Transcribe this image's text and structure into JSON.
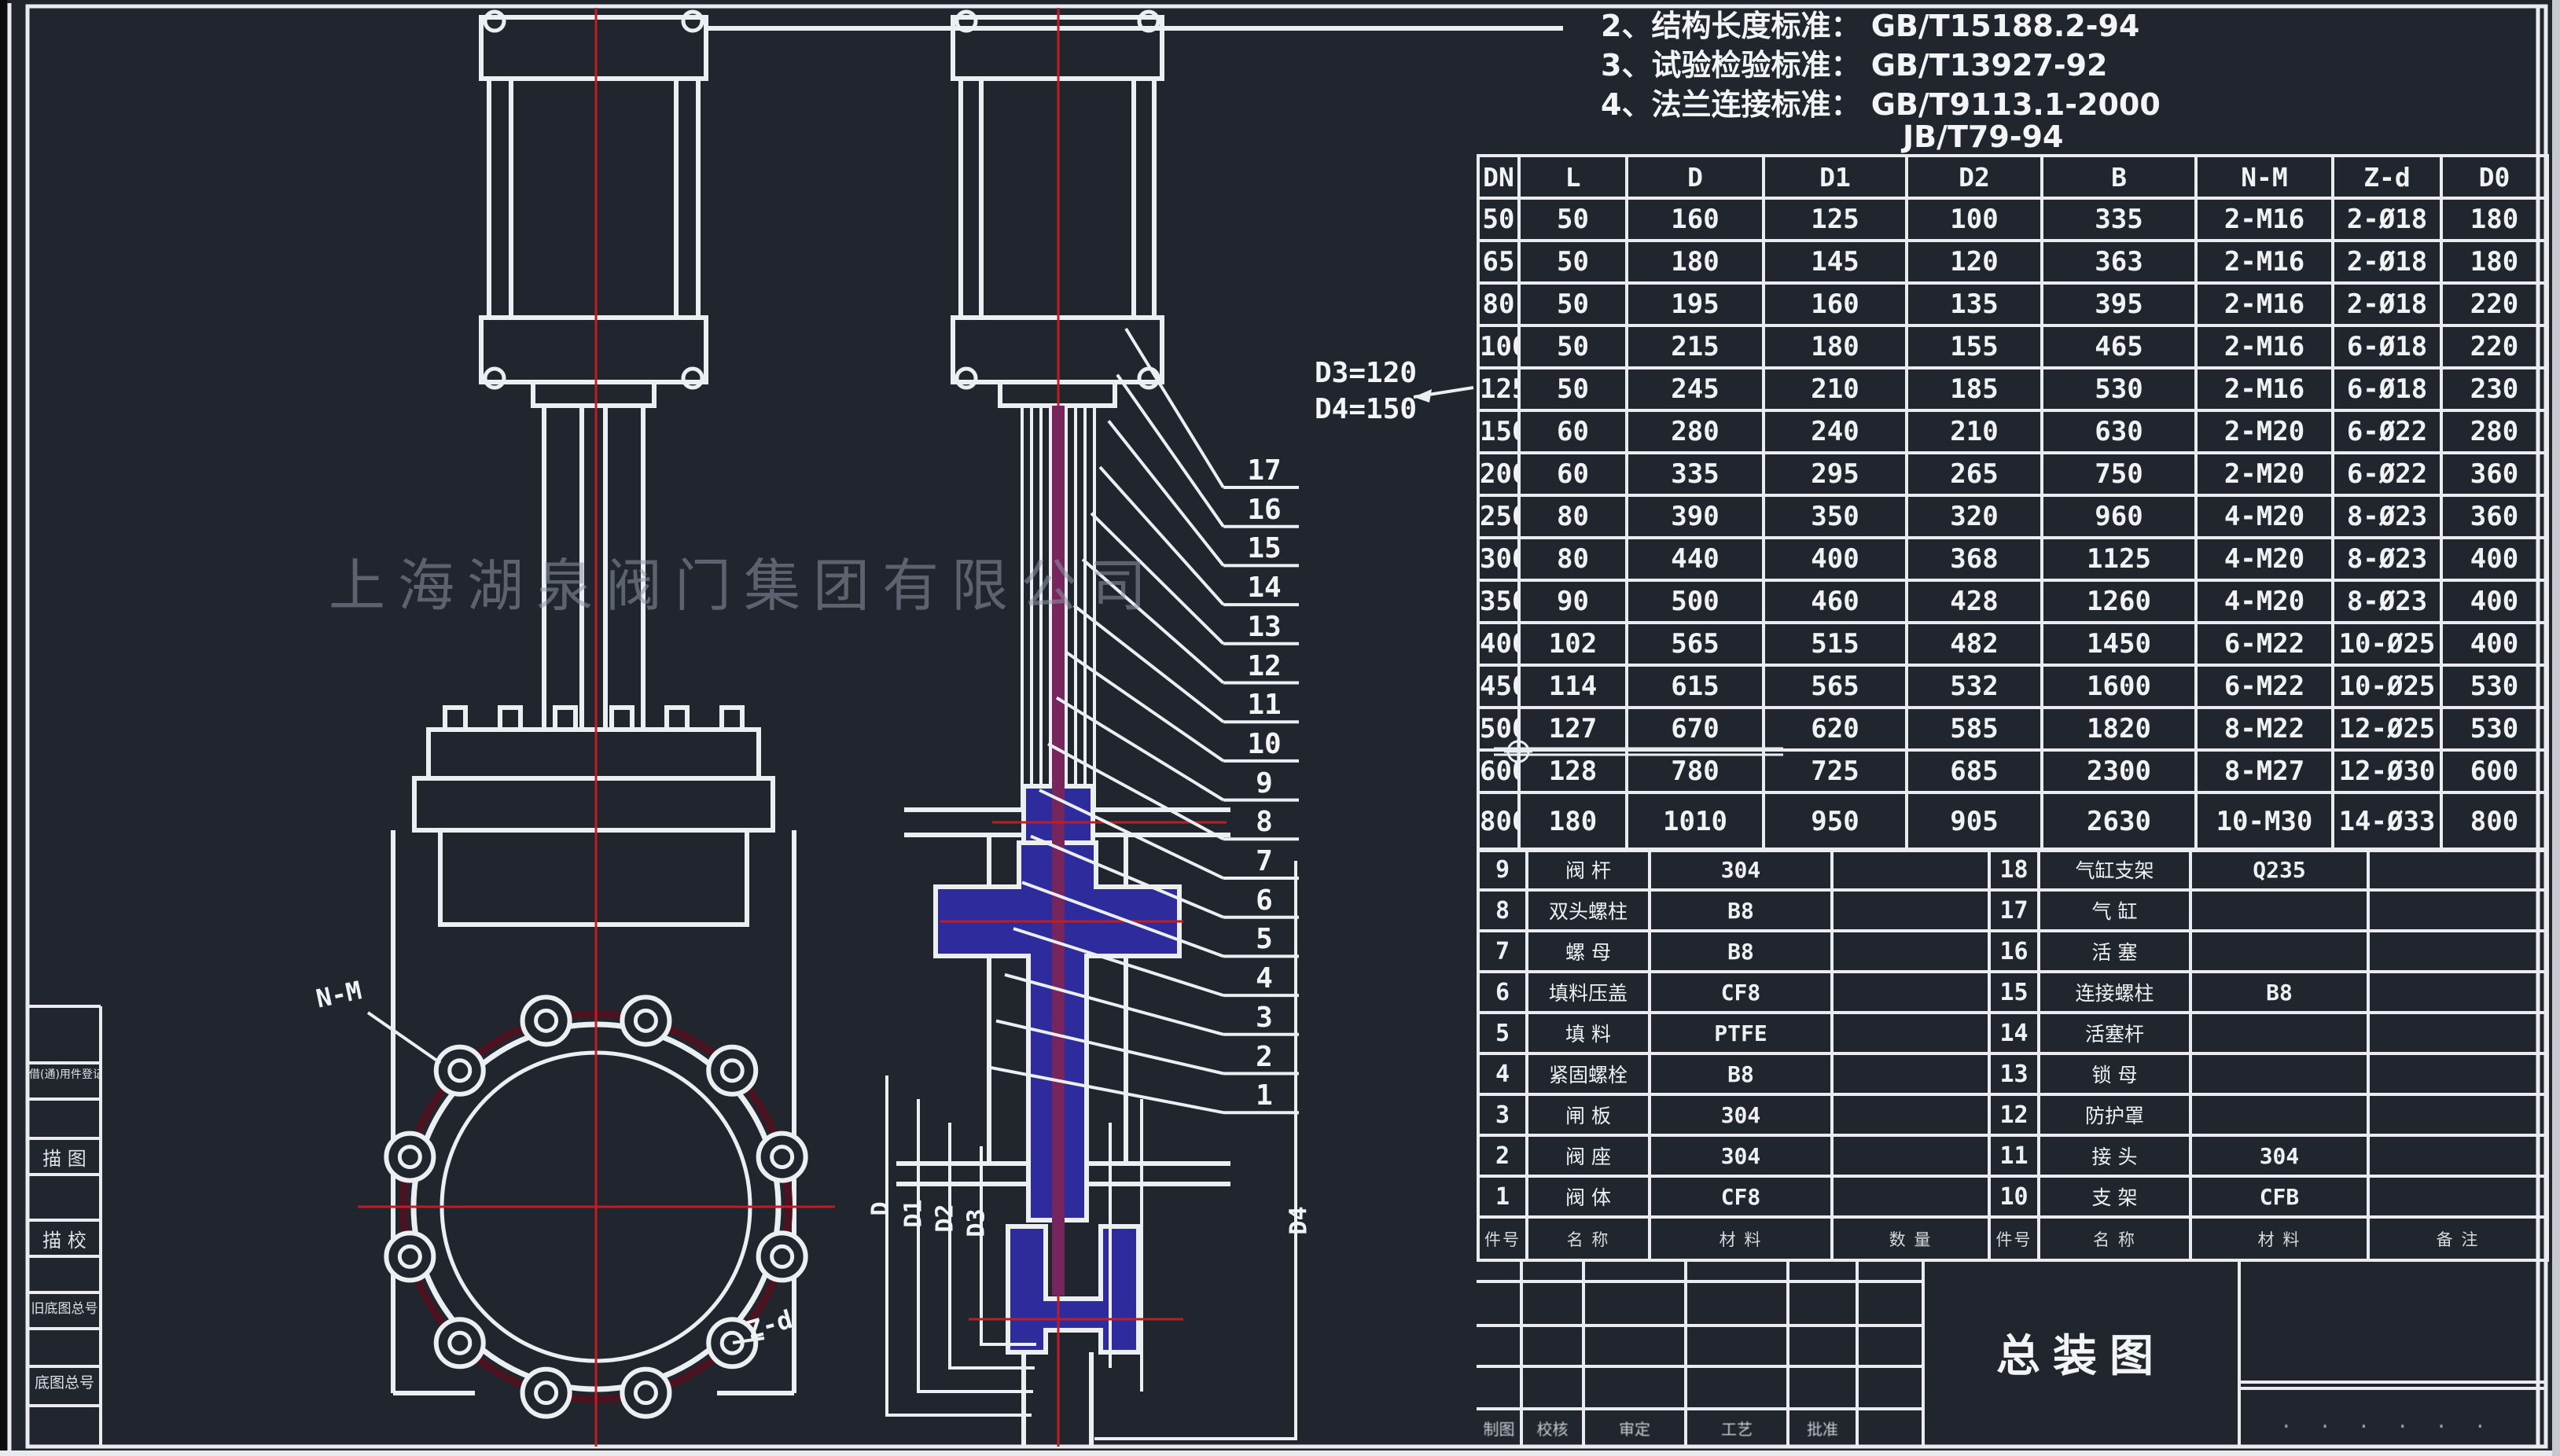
{
  "colors": {
    "background": "#21262e",
    "line_white": "#eceff2",
    "centerline_red": "#bf1d24",
    "bolt_circle_dark_red": "#4b1220",
    "section_fill_blue": "#2e2b9c",
    "stem_purple": "#76265c",
    "watermark_gray": "#8e96a6"
  },
  "standards_notes": [
    {
      "label": "2、结构长度标准：",
      "value": "GB/T15188.2-94"
    },
    {
      "label": "3、试验检验标准：",
      "value": "GB/T13927-92"
    },
    {
      "label": "4、法兰连接标准：",
      "value": "GB/T9113.1-2000"
    },
    {
      "label": "",
      "value": "JB/T79-94"
    }
  ],
  "watermark": "上海湖泉阀门集团有限公司",
  "dimension_table": {
    "headers": [
      "DN",
      "L",
      "D",
      "D1",
      "D2",
      "B",
      "N-M",
      "Z-d",
      "D0"
    ],
    "rows": [
      [
        "50",
        "50",
        "160",
        "125",
        "100",
        "335",
        "2-M16",
        "2-Ø18",
        "180"
      ],
      [
        "65",
        "50",
        "180",
        "145",
        "120",
        "363",
        "2-M16",
        "2-Ø18",
        "180"
      ],
      [
        "80",
        "50",
        "195",
        "160",
        "135",
        "395",
        "2-M16",
        "2-Ø18",
        "220"
      ],
      [
        "100",
        "50",
        "215",
        "180",
        "155",
        "465",
        "2-M16",
        "6-Ø18",
        "220"
      ],
      [
        "125",
        "50",
        "245",
        "210",
        "185",
        "530",
        "2-M16",
        "6-Ø18",
        "230"
      ],
      [
        "150",
        "60",
        "280",
        "240",
        "210",
        "630",
        "2-M20",
        "6-Ø22",
        "280"
      ],
      [
        "200",
        "60",
        "335",
        "295",
        "265",
        "750",
        "2-M20",
        "6-Ø22",
        "360"
      ],
      [
        "250",
        "80",
        "390",
        "350",
        "320",
        "960",
        "4-M20",
        "8-Ø23",
        "360"
      ],
      [
        "300",
        "80",
        "440",
        "400",
        "368",
        "1125",
        "4-M20",
        "8-Ø23",
        "400"
      ],
      [
        "350",
        "90",
        "500",
        "460",
        "428",
        "1260",
        "4-M20",
        "8-Ø23",
        "400"
      ],
      [
        "400",
        "102",
        "565",
        "515",
        "482",
        "1450",
        "6-M22",
        "10-Ø25",
        "400"
      ],
      [
        "450",
        "114",
        "615",
        "565",
        "532",
        "1600",
        "6-M22",
        "10-Ø25",
        "530"
      ],
      [
        "500",
        "127",
        "670",
        "620",
        "585",
        "1820",
        "8-M22",
        "12-Ø25",
        "530"
      ],
      [
        "600",
        "128",
        "780",
        "725",
        "685",
        "2300",
        "8-M27",
        "12-Ø30",
        "600"
      ],
      [
        "800",
        "180",
        "1010",
        "950",
        "905",
        "2630",
        "10-M30",
        "14-Ø33",
        "800"
      ]
    ]
  },
  "parts_list_left": [
    [
      "9",
      "阀 杆",
      "304",
      ""
    ],
    [
      "8",
      "双头螺柱",
      "B8",
      ""
    ],
    [
      "7",
      "螺 母",
      "B8",
      ""
    ],
    [
      "6",
      "填料压盖",
      "CF8",
      ""
    ],
    [
      "5",
      "填 料",
      "PTFE",
      ""
    ],
    [
      "4",
      "紧固螺栓",
      "B8",
      ""
    ],
    [
      "3",
      "闸 板",
      "304",
      ""
    ],
    [
      "2",
      "阀 座",
      "304",
      ""
    ],
    [
      "1",
      "阀 体",
      "CF8",
      ""
    ]
  ],
  "parts_list_right": [
    [
      "18",
      "气缸支架",
      "Q235",
      ""
    ],
    [
      "17",
      "气 缸",
      "",
      ""
    ],
    [
      "16",
      "活 塞",
      "",
      ""
    ],
    [
      "15",
      "连接螺柱",
      "B8",
      ""
    ],
    [
      "14",
      "活塞杆",
      "",
      ""
    ],
    [
      "13",
      "锁 母",
      "",
      ""
    ],
    [
      "12",
      "防护罩",
      "",
      ""
    ],
    [
      "11",
      "接 头",
      "304",
      ""
    ],
    [
      "10",
      "支 架",
      "CFB",
      ""
    ]
  ],
  "parts_header_left": [
    "件号",
    "名  称",
    "材  料",
    "数 量"
  ],
  "parts_header_right": [
    "件号",
    "名  称",
    "材  料",
    "备 注"
  ],
  "callout_numbers": [
    "17",
    "16",
    "15",
    "14",
    "13",
    "12",
    "11",
    "10",
    "9",
    "8",
    "7",
    "6",
    "5",
    "4",
    "3",
    "2",
    "1"
  ],
  "view_labels": {
    "nm": "N-M",
    "zd": "Z-d",
    "d_note_line1": "D3=120",
    "d_note_line2": "D4=150",
    "dims": [
      "D",
      "D1",
      "D2",
      "D3"
    ],
    "d4": "D4"
  },
  "margin_labels": [
    "借(通)用件登记",
    "描 图",
    "描 校",
    "旧底图总号",
    "底图总号"
  ],
  "title_block": {
    "title": "总装图",
    "sign_cells": [
      "制图",
      "校核",
      "审定",
      "工艺",
      "批准"
    ],
    "corner_marks": "· · ·   · ·  ·"
  }
}
